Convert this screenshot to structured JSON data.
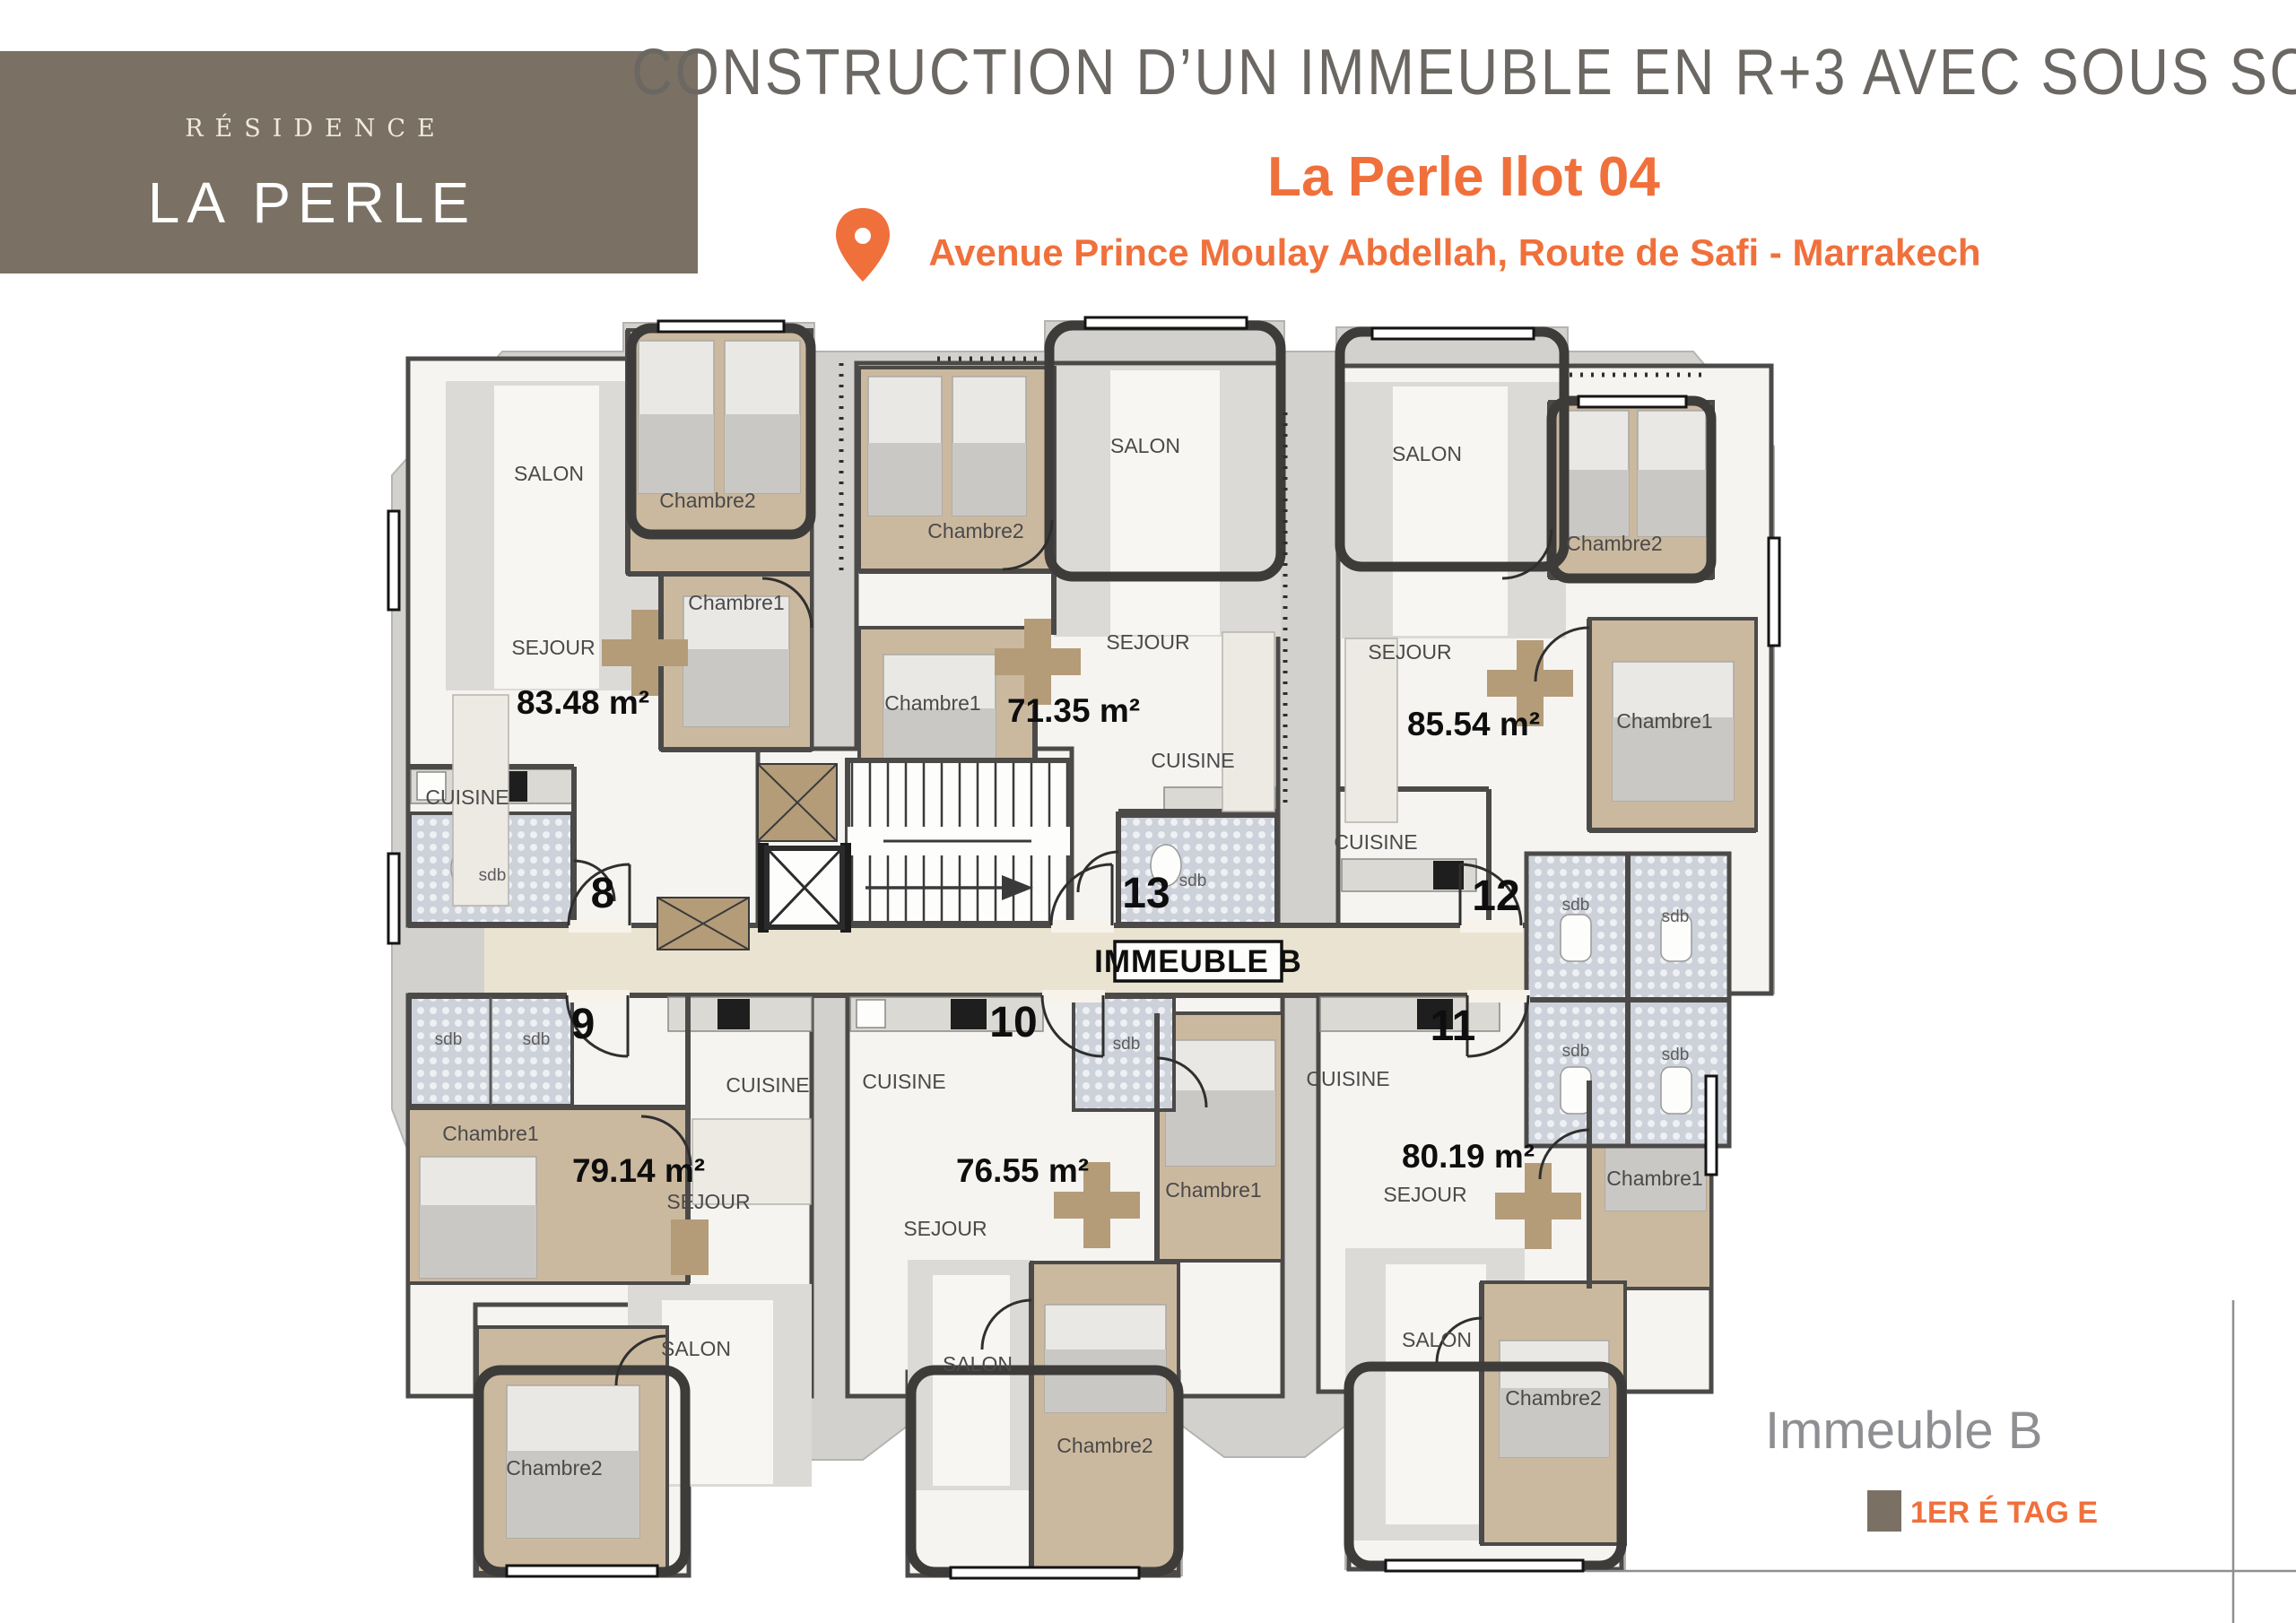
{
  "header": {
    "logo_line1": "RÉSIDENCE",
    "logo_line2": "LA PERLE",
    "title": "CONSTRUCTION D’UN IMMEUBLE EN R+3 AVEC SOUS SOL",
    "subtitle": "La Perle Ilot 04",
    "address": "Avenue Prince Moulay Abdellah, Route de Safi - Marrakech"
  },
  "plan": {
    "building_badge": "IMMEUBLE B",
    "floor_shown": "1er étage",
    "labels": {
      "salon": "SALON",
      "sejour": "SEJOUR",
      "cuisine": "CUISINE",
      "chambre1": "Chambre1",
      "chambre2": "Chambre2",
      "sdb": "sdb"
    },
    "units": [
      {
        "number": "8",
        "area": "83.48 m²"
      },
      {
        "number": "13",
        "area": "71.35 m²"
      },
      {
        "number": "12",
        "area": "85.54 m²"
      },
      {
        "number": "9",
        "area": "79.14 m²"
      },
      {
        "number": "10",
        "area": "76.55 m²"
      },
      {
        "number": "11",
        "area": "80.19 m²"
      }
    ]
  },
  "footer": {
    "building_name": "Immeuble B",
    "floor_label": "1ER É TAG E"
  },
  "colors": {
    "accent_orange": "#F0703C",
    "brand_brown": "#7A7164",
    "title_gray": "#6B6763",
    "footer_gray": "#8E8F92"
  }
}
